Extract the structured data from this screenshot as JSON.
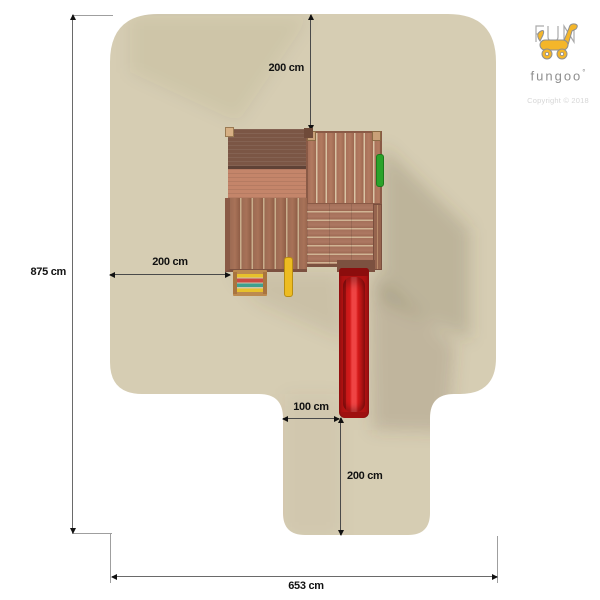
{
  "brand": {
    "name": "fungoo",
    "mark": "°",
    "copyright": "Copyright © 2018"
  },
  "dimensions": {
    "top_clearance": "200 cm",
    "total_depth": "875 cm",
    "side_clearance": "200 cm",
    "slide_offset": "100 cm",
    "slide_runout": "200 cm",
    "total_width": "653 cm"
  },
  "icons": {
    "logo": "fungoo-animal-logo"
  },
  "colors": {
    "background": "#ffffff",
    "safety_zone": "#d6cdb3",
    "zone_shadow": "#5a4e38",
    "wood_roof_dark": "#7b5645",
    "wood_roof_light": "#c4856a",
    "wood_deck": "#9c6b53",
    "wood_plank_gap": "#d9c3a4",
    "slide_red": "#c41717",
    "pole_yellow": "#edbc22",
    "ladder_rung_red": "#cb4a42",
    "ladder_rung_teal": "#3fa08e",
    "accessory_green": "#2aa32a",
    "dimension_line": "#4a4a4a",
    "logo_yellow": "#f4b62a",
    "logo_gray": "#8f8f8f"
  }
}
